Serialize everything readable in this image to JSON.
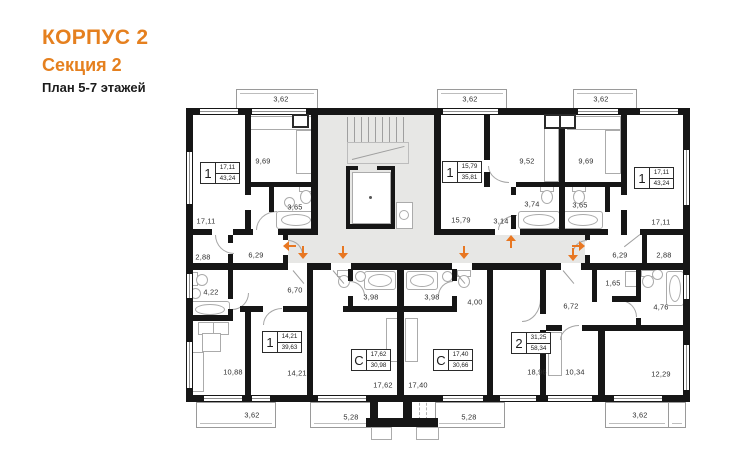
{
  "title": {
    "line1": "КОРПУС 2",
    "line2": "Секция 2",
    "line3": "План 5-7 этажей"
  },
  "colors": {
    "accent": "#e5801f",
    "arrow": "#e87722",
    "wall": "#161616",
    "corridor": "#e7e7e5"
  },
  "units": {
    "a": {
      "type": "1",
      "room_area": "17,11",
      "total_area": "43,24"
    },
    "b": {
      "type": "1",
      "room_area": "15,79",
      "total_area": "35,81"
    },
    "c": {
      "type": "1",
      "room_area": "17,11",
      "total_area": "43,24"
    },
    "d": {
      "type": "1",
      "room_area": "14,21",
      "total_area": "39,63"
    },
    "e": {
      "type": "С",
      "room_area": "17,62",
      "total_area": "30,98"
    },
    "f": {
      "type": "С",
      "room_area": "17,40",
      "total_area": "30,66"
    },
    "g": {
      "type": "2",
      "room_area": "31,25",
      "total_area": "58,34"
    }
  },
  "rooms": {
    "bal_a_top": "3,62",
    "bal_b_top": "3,62",
    "bal_c_top": "3,62",
    "a_kitchen": "9,69",
    "a_bath": "3,65",
    "a_room": "17,11",
    "a_ward": "2,88",
    "a_hall": "6,29",
    "b_room": "15,79",
    "b_kitchen": "9,52",
    "b_bath": "3,74",
    "b_hall": "3,14",
    "c_kitchen": "9,69",
    "c_bath": "3,65",
    "c_room": "17,11",
    "c_hall": "6,29",
    "c_ward": "2,88",
    "d_bath": "4,22",
    "d_hall": "6,70",
    "d_kitchen": "10,88",
    "d_room": "14,21",
    "d_balcony": "3,62",
    "e_bath": "3,98",
    "e_room": "17,62",
    "e_balcony": "5,28",
    "f_bath": "3,98",
    "f_hall": "4,00",
    "f_room": "17,40",
    "f_balcony": "5,28",
    "g_hall": "6,72",
    "g_wc": "1,65",
    "g_bath": "4,76",
    "g_room1": "18,96",
    "g_kitchen": "10,34",
    "g_room2": "12,29",
    "g_balcony": "3,62"
  }
}
